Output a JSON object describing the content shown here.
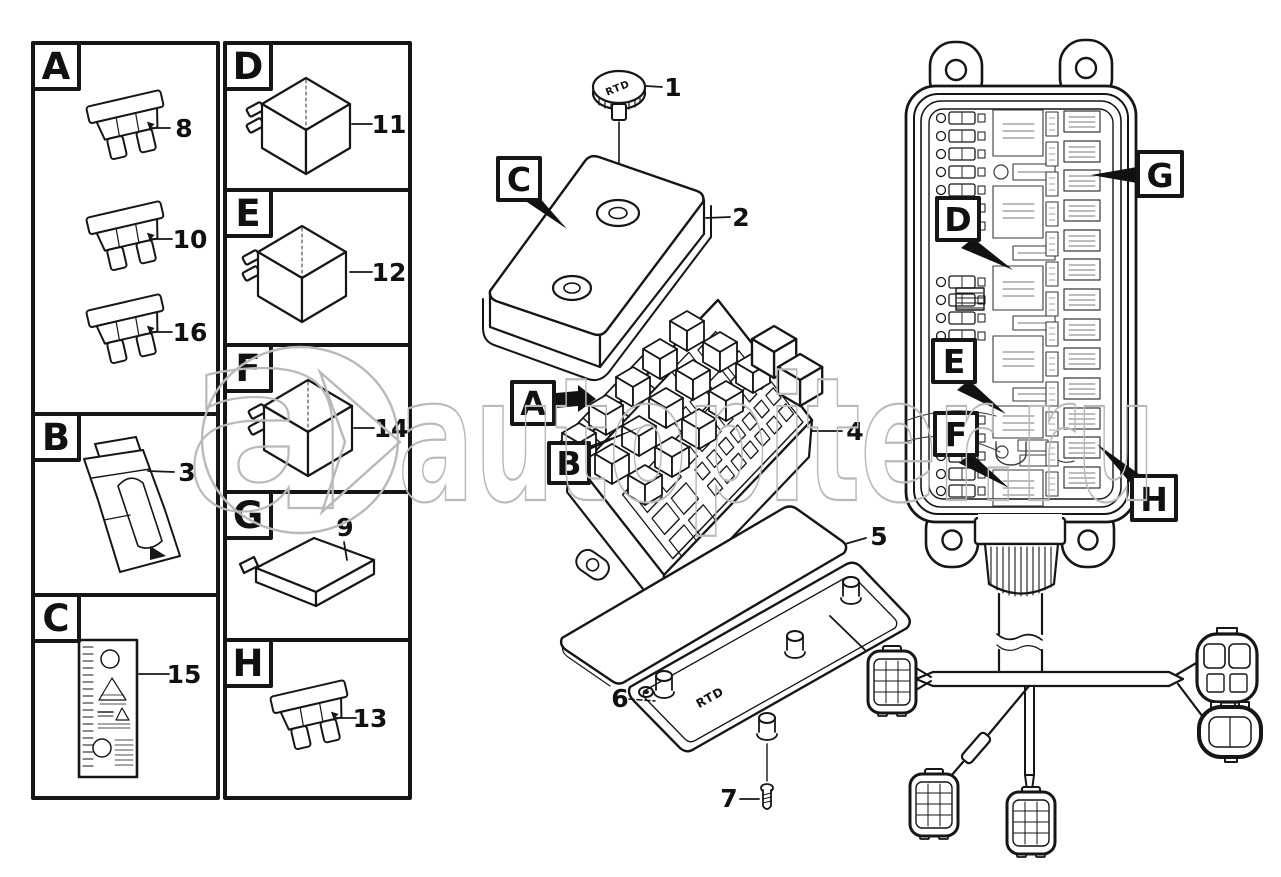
{
  "watermark": {
    "text": "autopiter.ru",
    "logo_letter": "a",
    "color": "#b9b9b9"
  },
  "legend": {
    "a": {
      "letter": "A",
      "fuse_numbers": [
        "8",
        "10",
        "16"
      ]
    },
    "b": {
      "letter": "B",
      "part_number": "3"
    },
    "c": {
      "letter": "C",
      "part_number": "15"
    },
    "d": {
      "letter": "D",
      "part_number": "11"
    },
    "e": {
      "letter": "E",
      "part_number": "12"
    },
    "f": {
      "letter": "F",
      "part_number": "14"
    },
    "g": {
      "letter": "G",
      "part_number": "9"
    },
    "h": {
      "letter": "H",
      "part_number": "13"
    }
  },
  "exploded": {
    "thumbscrew": {
      "number": "1",
      "marking": "RTD"
    },
    "cover": {
      "number": "2",
      "callout": "C"
    },
    "fuse_block": {
      "number": "4",
      "callout_fuses": "A",
      "callout_relays": "B"
    },
    "gasket": {
      "number": "5"
    },
    "housing": {
      "number": "6",
      "marking": "RTD"
    },
    "screw": {
      "number": "7"
    }
  },
  "panel": {
    "callouts": {
      "d": "D",
      "e": "E",
      "f": "F",
      "g": "G",
      "h": "H"
    }
  }
}
